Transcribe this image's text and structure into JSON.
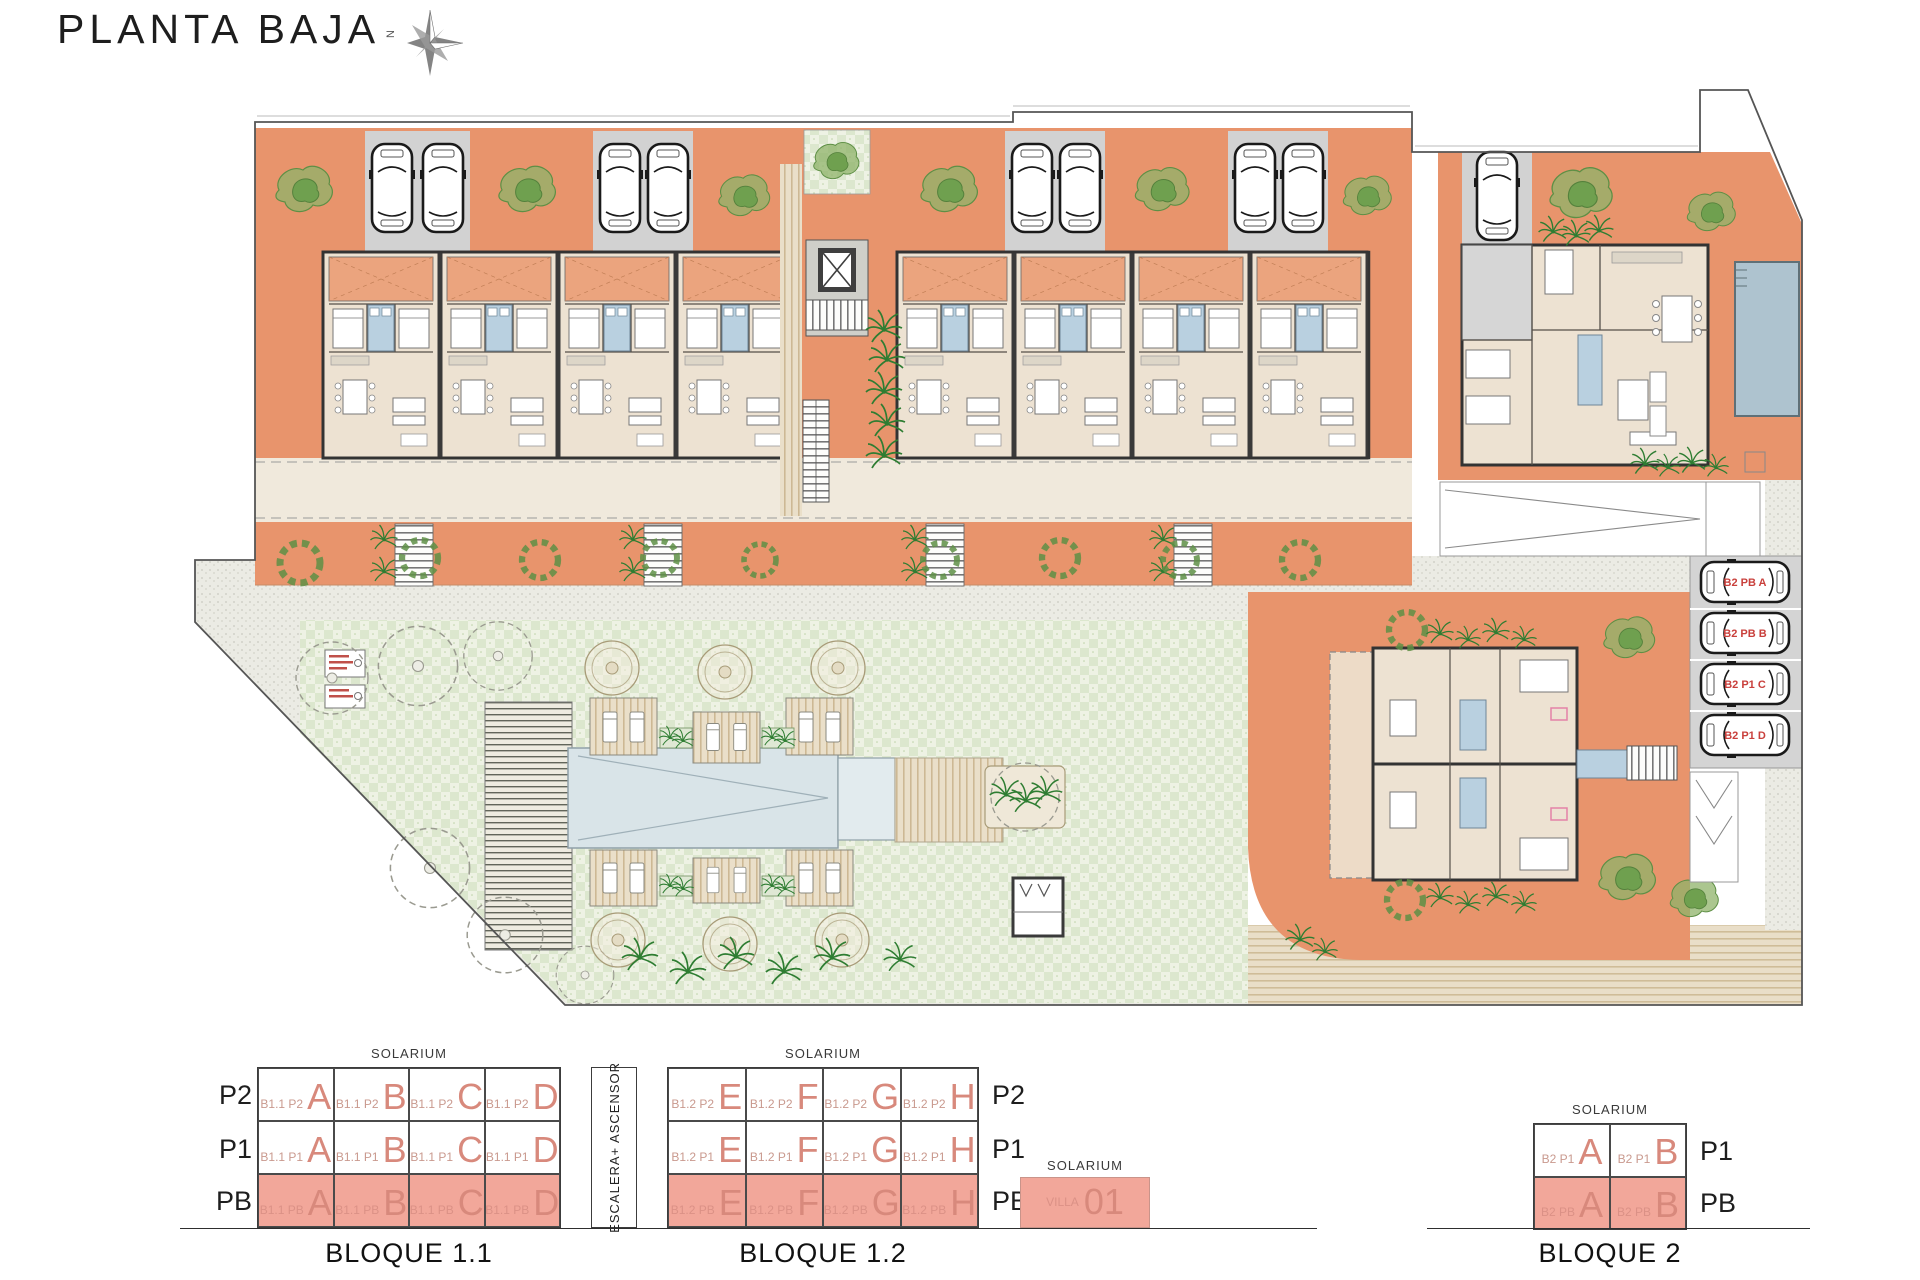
{
  "title": "PLANTA BAJA",
  "compass_label": "N",
  "colors": {
    "terracotta": "#E8946C",
    "floor_beige": "#EDE2D2",
    "parking_gray": "#D2D2D2",
    "pool_blue": "#AEC3CF",
    "pool_pale": "#D9E4E8",
    "lawn_green": "#DCE7CE",
    "bath_blue": "#B9D0E0",
    "highlight_pink": "#F2A79A",
    "unit_letter_salmon": "#D8897C",
    "parking_label_red": "#C9403C"
  },
  "plan": {
    "parking_labels": [
      "B2 PB A",
      "B2 PB B",
      "B2 P1 C",
      "B2 P1 D"
    ]
  },
  "legend": {
    "solarium": "SOLARIUM",
    "escalera": "ESCALERA+ ASCENSOR",
    "b11": {
      "name": "BLOQUE 1.1",
      "rows": [
        {
          "floor": "P2",
          "cells": [
            {
              "prefix": "B1.1 P2",
              "letter": "A"
            },
            {
              "prefix": "B1.1 P2",
              "letter": "B"
            },
            {
              "prefix": "B1.1 P2",
              "letter": "C"
            },
            {
              "prefix": "B1.1 P2",
              "letter": "D"
            }
          ]
        },
        {
          "floor": "P1",
          "cells": [
            {
              "prefix": "B1.1 P1",
              "letter": "A"
            },
            {
              "prefix": "B1.1 P1",
              "letter": "B"
            },
            {
              "prefix": "B1.1 P1",
              "letter": "C"
            },
            {
              "prefix": "B1.1 P1",
              "letter": "D"
            }
          ]
        },
        {
          "floor": "PB",
          "cells": [
            {
              "prefix": "B1.1 PB",
              "letter": "A"
            },
            {
              "prefix": "B1.1 PB",
              "letter": "B"
            },
            {
              "prefix": "B1.1 PB",
              "letter": "C"
            },
            {
              "prefix": "B1.1 PB",
              "letter": "D"
            }
          ]
        }
      ]
    },
    "b12": {
      "name": "BLOQUE 1.2",
      "rows": [
        {
          "floor": "P2",
          "cells": [
            {
              "prefix": "B1.2 P2",
              "letter": "E"
            },
            {
              "prefix": "B1.2 P2",
              "letter": "F"
            },
            {
              "prefix": "B1.2 P2",
              "letter": "G"
            },
            {
              "prefix": "B1.2 P2",
              "letter": "H"
            }
          ]
        },
        {
          "floor": "P1",
          "cells": [
            {
              "prefix": "B1.2 P1",
              "letter": "E"
            },
            {
              "prefix": "B1.2 P1",
              "letter": "F"
            },
            {
              "prefix": "B1.2 P1",
              "letter": "G"
            },
            {
              "prefix": "B1.2 P1",
              "letter": "H"
            }
          ]
        },
        {
          "floor": "PB",
          "cells": [
            {
              "prefix": "B1.2 PB",
              "letter": "E"
            },
            {
              "prefix": "B1.2 PB",
              "letter": "F"
            },
            {
              "prefix": "B1.2 PB",
              "letter": "G"
            },
            {
              "prefix": "B1.2 PB",
              "letter": "H"
            }
          ]
        }
      ]
    },
    "villa": {
      "prefix": "VILLA",
      "number": "01"
    },
    "b2": {
      "name": "BLOQUE 2",
      "rows": [
        {
          "floor": "P1",
          "cells": [
            {
              "prefix": "B2 P1",
              "letter": "A"
            },
            {
              "prefix": "B2 P1",
              "letter": "B"
            }
          ]
        },
        {
          "floor": "PB",
          "cells": [
            {
              "prefix": "B2 PB",
              "letter": "A"
            },
            {
              "prefix": "B2 PB",
              "letter": "B"
            }
          ]
        }
      ]
    }
  }
}
